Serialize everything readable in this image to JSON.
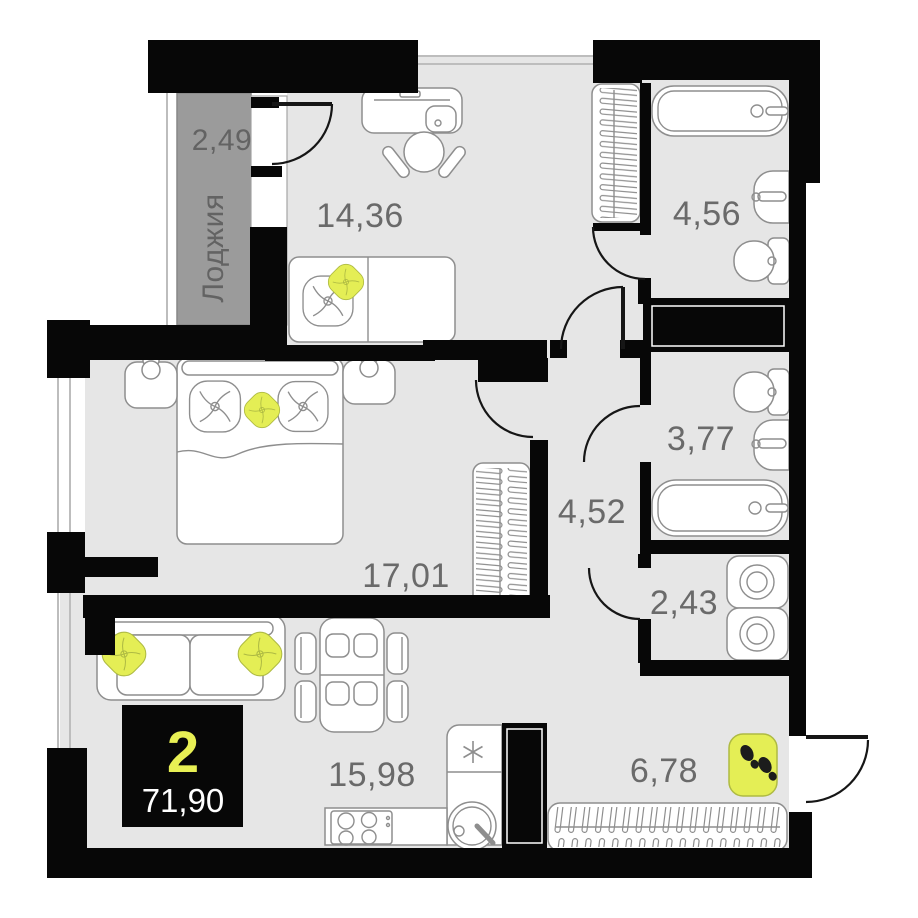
{
  "plan": {
    "badge": {
      "rooms_count": "2",
      "total_area": "71,90"
    },
    "loggia": {
      "name": "Лоджия",
      "area": "2,49"
    },
    "rooms": {
      "room_14": {
        "area": "14,36"
      },
      "bathroom": {
        "area": "4,56"
      },
      "wc": {
        "area": "3,77"
      },
      "hallway": {
        "area": "4,52"
      },
      "bedroom": {
        "area": "17,01"
      },
      "laundry": {
        "area": "2,43"
      },
      "kitchen_living": {
        "area": "15,98"
      },
      "entry": {
        "area": "6,78"
      }
    },
    "icons": {
      "fridge_marker": "✳"
    },
    "colors": {
      "wall": "#070707",
      "floor": "#e6e6e6",
      "loggia_floor": "#9b9b9b",
      "accent_yellow": "#e4ee55",
      "label_text": "#6a6a6a",
      "badge_bg": "#070707",
      "badge_number": "#e8f054",
      "badge_area": "#ffffff"
    }
  }
}
